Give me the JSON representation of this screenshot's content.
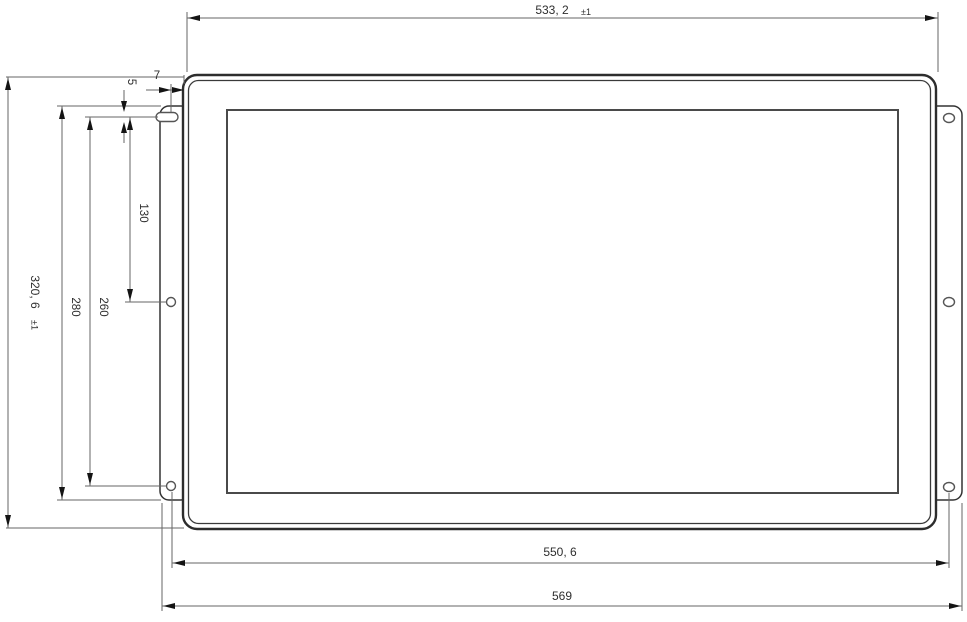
{
  "drawing": {
    "type": "technical-dimension-drawing",
    "subject": "open-frame display panel, front view with mounting brackets",
    "units": "mm",
    "colors": {
      "background": "#ffffff",
      "object_line": "#2d2d2d",
      "dimension_line": "#666666",
      "text": "#2e2e2e"
    },
    "dims": {
      "top_width": {
        "value": "533, 2",
        "tol": "±1"
      },
      "panel_height": {
        "value": "320, 6",
        "tol": "±1"
      },
      "slot_height": {
        "value": "5"
      },
      "slot_offset": {
        "value": "7"
      },
      "hole_span_upper": {
        "value": "130"
      },
      "hole_span_outer": {
        "value": "260"
      },
      "bracket_height": {
        "value": "280"
      },
      "mount_hole_span": {
        "value": "550, 6"
      },
      "overall_width": {
        "value": "569"
      }
    }
  }
}
